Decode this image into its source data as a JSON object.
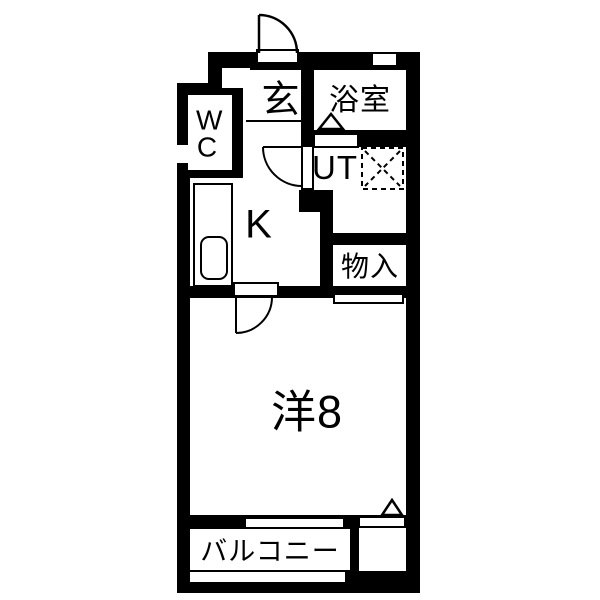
{
  "plan": {
    "type": "japanese-apartment-floor-plan",
    "rooms": {
      "genkan": {
        "label": "玄"
      },
      "bathroom": {
        "label": "浴室"
      },
      "wc": {
        "label": "WC"
      },
      "utility": {
        "label": "UT"
      },
      "kitchen": {
        "label": "K"
      },
      "storage": {
        "label": "物入"
      },
      "western_room": {
        "label": "洋8"
      },
      "balcony": {
        "label": "バルコニー"
      }
    },
    "colors": {
      "wall": "#000000",
      "floor": "#ffffff",
      "line": "#000000"
    }
  }
}
